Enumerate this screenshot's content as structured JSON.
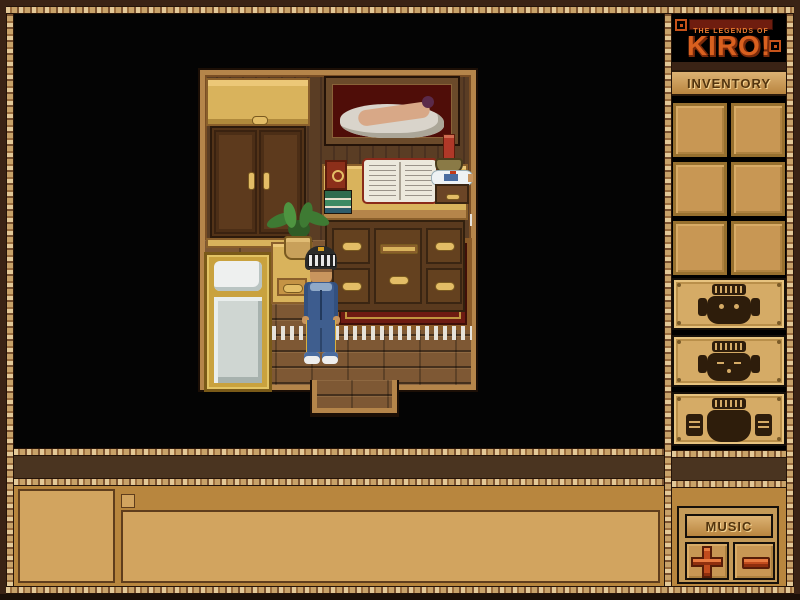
{
  "logo": {
    "tagline": "THE LEGENDS OF",
    "title": "KIRO!"
  },
  "sidebar": {
    "inventory": {
      "label": "INVENTORY",
      "slot_count": 6,
      "slots": [
        "empty",
        "empty",
        "empty",
        "empty",
        "empty",
        "empty"
      ]
    },
    "action_buttons": [
      {
        "icon": "tiki-mask-awake-icon"
      },
      {
        "icon": "tiki-mask-asleep-icon"
      },
      {
        "icon": "tiki-mask-hands-icon"
      }
    ],
    "music": {
      "label": "MUSIC",
      "increase_icon": "plus-icon",
      "decrease_icon": "minus-icon"
    }
  },
  "message_bar": {
    "portrait": "",
    "chat_text": ""
  },
  "scene": {
    "objects": [
      "wardrobe",
      "nude-painting",
      "desk-with-drawers",
      "open-book",
      "red-book",
      "book-stack",
      "candle",
      "ship-in-bottle",
      "small-wooden-box",
      "potted-fern",
      "nightstand",
      "bed",
      "red-rug",
      "player-character",
      "doorway"
    ],
    "player": {
      "outfit": "blue denim jacket and pants, striped helmet, white sneakers"
    }
  },
  "colors": {
    "accent_orange": "#d9601f",
    "panel_gold": "#b8863e",
    "box_tan": "#d2a45f",
    "slot_tan": "#c89754",
    "dark_band": "#4a3420",
    "frame_dark": "#3a2315",
    "button_red": "#c14b1d",
    "text_brown": "#53350f",
    "rug_red": "#6e1b12"
  }
}
